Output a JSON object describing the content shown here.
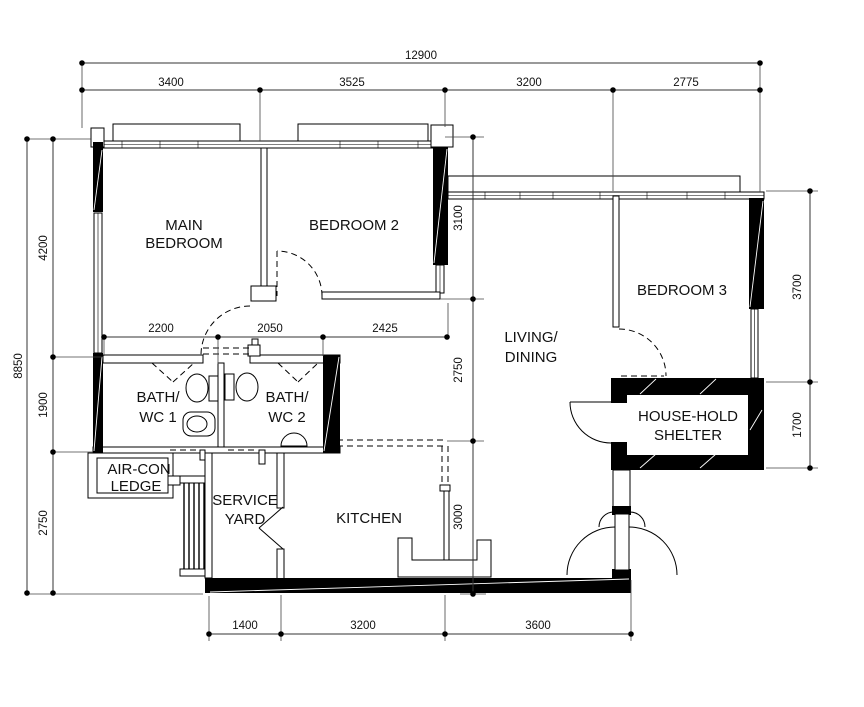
{
  "page": {
    "background": "#ffffff",
    "ink": "#000000"
  },
  "rooms": {
    "main_bedroom": {
      "line1": "MAIN",
      "line2": "BEDROOM"
    },
    "bedroom_2": {
      "line1": "BEDROOM 2"
    },
    "bedroom_3": {
      "line1": "BEDROOM 3"
    },
    "living_dining": {
      "line1": "LIVING/",
      "line2": "DINING"
    },
    "bath_wc_1": {
      "line1": "BATH/",
      "line2": "WC 1"
    },
    "bath_wc_2": {
      "line1": "BATH/",
      "line2": "WC 2"
    },
    "aircon_ledge": {
      "line1": "AIR-CON",
      "line2": "LEDGE"
    },
    "service_yard": {
      "line1": "SERVICE",
      "line2": "YARD"
    },
    "kitchen": {
      "line1": "KITCHEN"
    },
    "household_shelter": {
      "line1": "HOUSE-HOLD",
      "line2": "SHELTER"
    }
  },
  "dimensions": {
    "overall_width": "12900",
    "top": [
      "3400",
      "3525",
      "3200",
      "2775"
    ],
    "overall_height": "8850",
    "left": [
      "4200",
      "1900",
      "2750"
    ],
    "bottom": [
      "1400",
      "3200",
      "3600"
    ],
    "right": [
      "3700",
      "1700"
    ],
    "interior_horizontal": [
      "2200",
      "2050",
      "2425"
    ],
    "interior_vertical": [
      "3100",
      "2750",
      "3000"
    ]
  }
}
